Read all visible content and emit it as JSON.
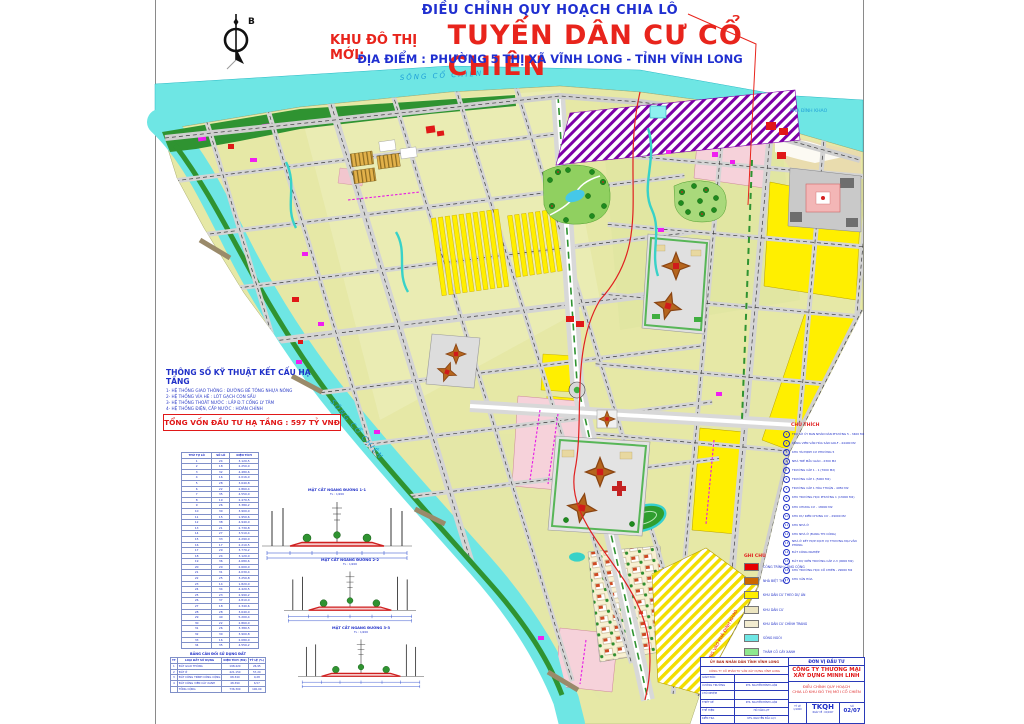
{
  "title": {
    "line1": "ĐIỀU CHỈNH QUY HOẠCH CHIA LÔ",
    "line2_prefix": "KHU ĐÔ THỊ MỚI:",
    "line2_main": "TUYẾN DÂN CƯ CỔ CHIÊN",
    "line3": "ĐỊA ĐIỂM : PHƯỜNG 5 THỊ XÃ VĨNH LONG - TỈNH VĨNH LONG"
  },
  "north_label": "B",
  "map_labels": {
    "river_top": "SÔNG CỔ CHIÊN",
    "river_left": "SÔNG CỔ CHIÊN",
    "ferry": "PHÀ ĐÌNH KHAO",
    "road_diagonal": "ĐƯỜNG VÀO PHÀ ĐÌNH KHAO"
  },
  "specs": {
    "title": "THÔNG SỐ KỸ THUẬT KẾT CẤU HẠ TẦNG",
    "lines": [
      "1- HỆ THỐNG GIAO THÔNG : ĐƯỜNG BÊ TÔNG NHỰA NÓNG",
      "2- HỆ THỐNG VỈA HÈ : LÓT GẠCH CON SẤU",
      "3- HỆ THỐNG THOÁT NƯỚC : LẮP Đ.T CỐNG LY TÂM",
      "4- HỆ THỐNG ĐIỆN, CẤP NƯỚC : HOÀN CHỈNH"
    ],
    "note1": "TẤT CẢ CÁC CHỈ TIÊU KỸ THUẬT ĐƯỢC THIẾT KẾ",
    "note2": "ĐẠT TIÊU CHUẨN KHU ĐÔ THỊ MỚI HIỆN ĐẠI",
    "total": "TỔNG VỐN ĐẦU TƯ HẠ TẦNG : 597 TỶ VNĐ"
  },
  "lot_table": {
    "headers": [
      "THỨ TỰ LÔ",
      "SỐ LÔ",
      "DIỆN TÍCH"
    ],
    "rows": [
      [
        "1",
        "24",
        "3.120,5"
      ],
      [
        "2",
        "18",
        "2.250,0"
      ],
      [
        "3",
        "32",
        "4.480,6"
      ],
      [
        "4",
        "16",
        "2.016,0"
      ],
      [
        "5",
        "28",
        "3.640,8"
      ],
      [
        "6",
        "22",
        "2.860,4"
      ],
      [
        "7",
        "35",
        "4.550,0"
      ],
      [
        "8",
        "19",
        "2.470,5"
      ],
      [
        "9",
        "26",
        "3.380,2"
      ],
      [
        "10",
        "30",
        "3.900,0"
      ],
      [
        "11",
        "15",
        "1.950,6"
      ],
      [
        "12",
        "38",
        "4.940,0"
      ],
      [
        "13",
        "21",
        "2.730,8"
      ],
      [
        "14",
        "27",
        "3.510,4"
      ],
      [
        "15",
        "33",
        "4.290,0"
      ],
      [
        "16",
        "17",
        "2.210,5"
      ],
      [
        "17",
        "29",
        "3.770,2"
      ],
      [
        "18",
        "24",
        "3.120,0"
      ],
      [
        "19",
        "36",
        "4.680,6"
      ],
      [
        "20",
        "20",
        "2.600,0"
      ],
      [
        "21",
        "31",
        "4.030,4"
      ],
      [
        "22",
        "25",
        "3.250,8"
      ],
      [
        "23",
        "14",
        "1.820,0"
      ],
      [
        "24",
        "34",
        "4.420,5"
      ],
      [
        "25",
        "23",
        "2.990,2"
      ],
      [
        "26",
        "37",
        "4.810,0"
      ],
      [
        "27",
        "18",
        "2.340,6"
      ],
      [
        "28",
        "28",
        "3.640,0"
      ],
      [
        "29",
        "40",
        "5.200,4"
      ],
      [
        "30",
        "22",
        "2.860,0"
      ],
      [
        "31",
        "26",
        "3.380,5"
      ],
      [
        "32",
        "30",
        "3.900,8"
      ],
      [
        "33",
        "16",
        "2.080,0"
      ],
      [
        "34",
        "35",
        "4.550,2"
      ]
    ]
  },
  "balance_table": {
    "title": "BẢNG CÂN ĐỐI SỬ DỤNG ĐẤT",
    "headers": [
      "TT",
      "LOẠI ĐẤT SỬ DỤNG",
      "DIỆN TÍCH (M2)",
      "TỶ LỆ (%)"
    ],
    "rows": [
      [
        "1",
        "ĐẤT GIAO THÔNG",
        "198.420",
        "26,95"
      ],
      [
        "2",
        "ĐẤT Ở",
        "421.150",
        "57,20"
      ],
      [
        "3",
        "ĐẤT CÔNG TRÌNH CÔNG CỘNG",
        "68.340",
        "9,28"
      ],
      [
        "4",
        "ĐẤT CÔNG VIÊN CÂY XANH",
        "48.390",
        "6,57"
      ],
      [
        "",
        "TỔNG CỘNG",
        "736.300",
        "100,00"
      ]
    ]
  },
  "sections": {
    "scale": "TL : 1/200",
    "titles": [
      "MẶT CẮT NGANG ĐƯỜNG 1-1",
      "MẶT CẮT NGANG ĐƯỜNG 2-2",
      "MẶT CẮT NGANG ĐƯỜNG 3-3"
    ]
  },
  "chu_thich": {
    "title": "CHÚ THÍCH",
    "items": [
      {
        "num": "1",
        "label": "TRỤ SỞ ỦY BAN NHÂN DÂN PHƯỜNG 5 - 3400 M2"
      },
      {
        "num": "2",
        "label": "CÔNG VIÊN VĂN HÓA SÂN GOLF - 44400 M2"
      },
      {
        "num": "3",
        "label": "KHU TÁI ĐỊNH CƯ PHƯỜNG 5"
      },
      {
        "num": "4",
        "label": "NHÀ TRẺ MẪU GIÁO - 2300 M2"
      },
      {
        "num": "5",
        "label": "TRƯỜNG CẤP 1 - 1 (7000 M2)"
      },
      {
        "num": "6",
        "label": "TRƯỜNG CẤP 1 (5000 M2)"
      },
      {
        "num": "7",
        "label": "TRƯỜNG CẤP 1 HÒA THUẬN - 4950 M2"
      },
      {
        "num": "8",
        "label": "KHU TRƯỜNG HỌC PHƯỜNG 1 (13000 M2)"
      },
      {
        "num": "9",
        "label": "KHU CHUNG CƯ - 18000 M2"
      },
      {
        "num": "10",
        "label": "KHU DỰ KIẾN CHUNG CƯ - 29000 M2"
      },
      {
        "num": "11",
        "label": "KHU NHÀ Ở"
      },
      {
        "num": "12",
        "label": "KHU NHÀ Ở (ĐANG THI CÔNG)"
      },
      {
        "num": "13",
        "label": "NHÀ Ở KẾT HỢP DỊCH VỤ THƯƠNG MẠI VĂN PHÒNG"
      },
      {
        "num": "14",
        "label": "ĐẤT CÔNG NGHIỆP"
      },
      {
        "num": "15",
        "label": "ĐẤT DỰ KIẾN TRƯỜNG CẤP 2-3 (9000 M2)"
      },
      {
        "num": "16",
        "label": "KHU TRƯỜNG HỌC CỔ CHIÊN - 29000 M2"
      },
      {
        "num": "17",
        "label": "KHU VĂN HÓA"
      }
    ]
  },
  "ghi_chu": {
    "title": "GHI CHÚ",
    "items": [
      {
        "color": "#e60000",
        "label": "CÔNG TRÌNH CÔNG CỘNG"
      },
      {
        "color": "#cc6600",
        "label": "NHÀ BIỆT THỰ"
      },
      {
        "color": "#ffef00",
        "label": "KHU DÂN CƯ THEO DỰ ÁN"
      },
      {
        "color": "#ece5c0",
        "label": "KHU DÂN CƯ"
      },
      {
        "color": "#f2ecd0",
        "label": "KHU DÂN CƯ CHỈNH TRANG"
      },
      {
        "color": "#6ee6e4",
        "label": "SÔNG NGÒI"
      },
      {
        "color": "#8ee88e",
        "label": "THẢM CỎ CÂY XANH"
      },
      {
        "color": "#f0d0e8",
        "label": "KHU CÔNG NGHIỆP"
      }
    ]
  },
  "title_block": {
    "agency": "ỦY BAN NHÂN DÂN TỈNH VĨNH LONG",
    "consultant": "CÔNG TY CỔ PHẦN TƯ VẤN XÂY DỰNG VĨNH LONG",
    "rows": [
      {
        "label": "GIÁM ĐỐC",
        "value": ""
      },
      {
        "label": "XƯỞNG TRƯỞNG",
        "value": "KTS. NGUYỄN ĐÌNH LUẬN"
      },
      {
        "label": "CHỦ NHIỆM",
        "value": ""
      },
      {
        "label": "THIẾT KẾ",
        "value": "KTS. NGUYỄN ĐÌNH LUẬN"
      },
      {
        "label": "THỂ HIỆN",
        "value": "HỒ VĂN LỰT"
      },
      {
        "label": "KIỂM TRA",
        "value": "KTS. NGUYỄN ĐẮC LỢI"
      }
    ],
    "investor_label": "ĐƠN VỊ ĐẦU TƯ",
    "investor_line1": "CÔNG TY THƯƠNG MẠI",
    "investor_line2": "XÂY DỰNG MINH LINH",
    "drawing_title1": "ĐIỀU CHỈNH QUY HOẠCH",
    "drawing_title2": "CHIA LÔ KHU ĐÔ THỊ MỚI CỔ CHIÊN",
    "scale_label": "TỶ LỆ",
    "scale_value": "1/1000",
    "code": "TKQH",
    "date_line": "NGÀY VẼ : 02/2007",
    "sheet_label": "SỐ",
    "sheet_value": "02/07"
  }
}
